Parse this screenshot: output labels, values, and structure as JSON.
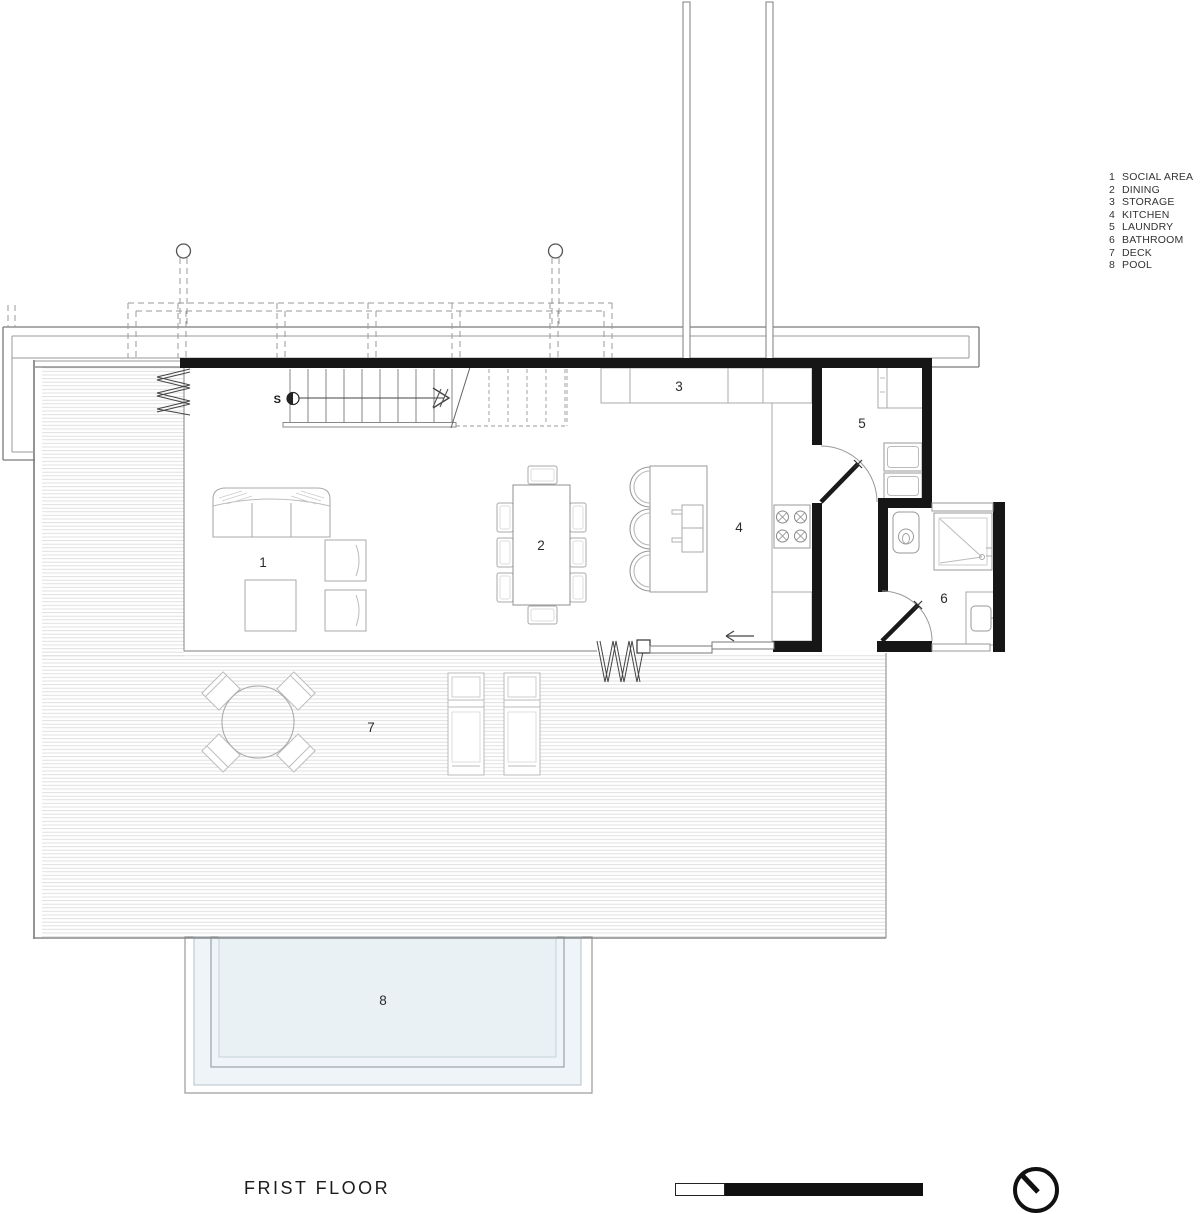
{
  "title": "FRIST FLOOR",
  "rooms": [
    {
      "num": "1",
      "label": "SOCIAL AREA"
    },
    {
      "num": "2",
      "label": "DINING"
    },
    {
      "num": "3",
      "label": "STORAGE"
    },
    {
      "num": "4",
      "label": "KITCHEN"
    },
    {
      "num": "5",
      "label": "LAUNDRY"
    },
    {
      "num": "6",
      "label": "BATHROOM"
    },
    {
      "num": "7",
      "label": "DECK"
    },
    {
      "num": "8",
      "label": "POOL"
    }
  ],
  "stairs": {
    "label": "S"
  },
  "colors": {
    "wall": "#161616",
    "furniture_line": "#a8a8a8",
    "deck_hatch": "#dcdcdc",
    "band_line": "#7a7a7a",
    "dashed_line": "#9a9a9a",
    "pool_fill": "#eef4f7",
    "pool_inner_fill": "#e9f1f5"
  }
}
